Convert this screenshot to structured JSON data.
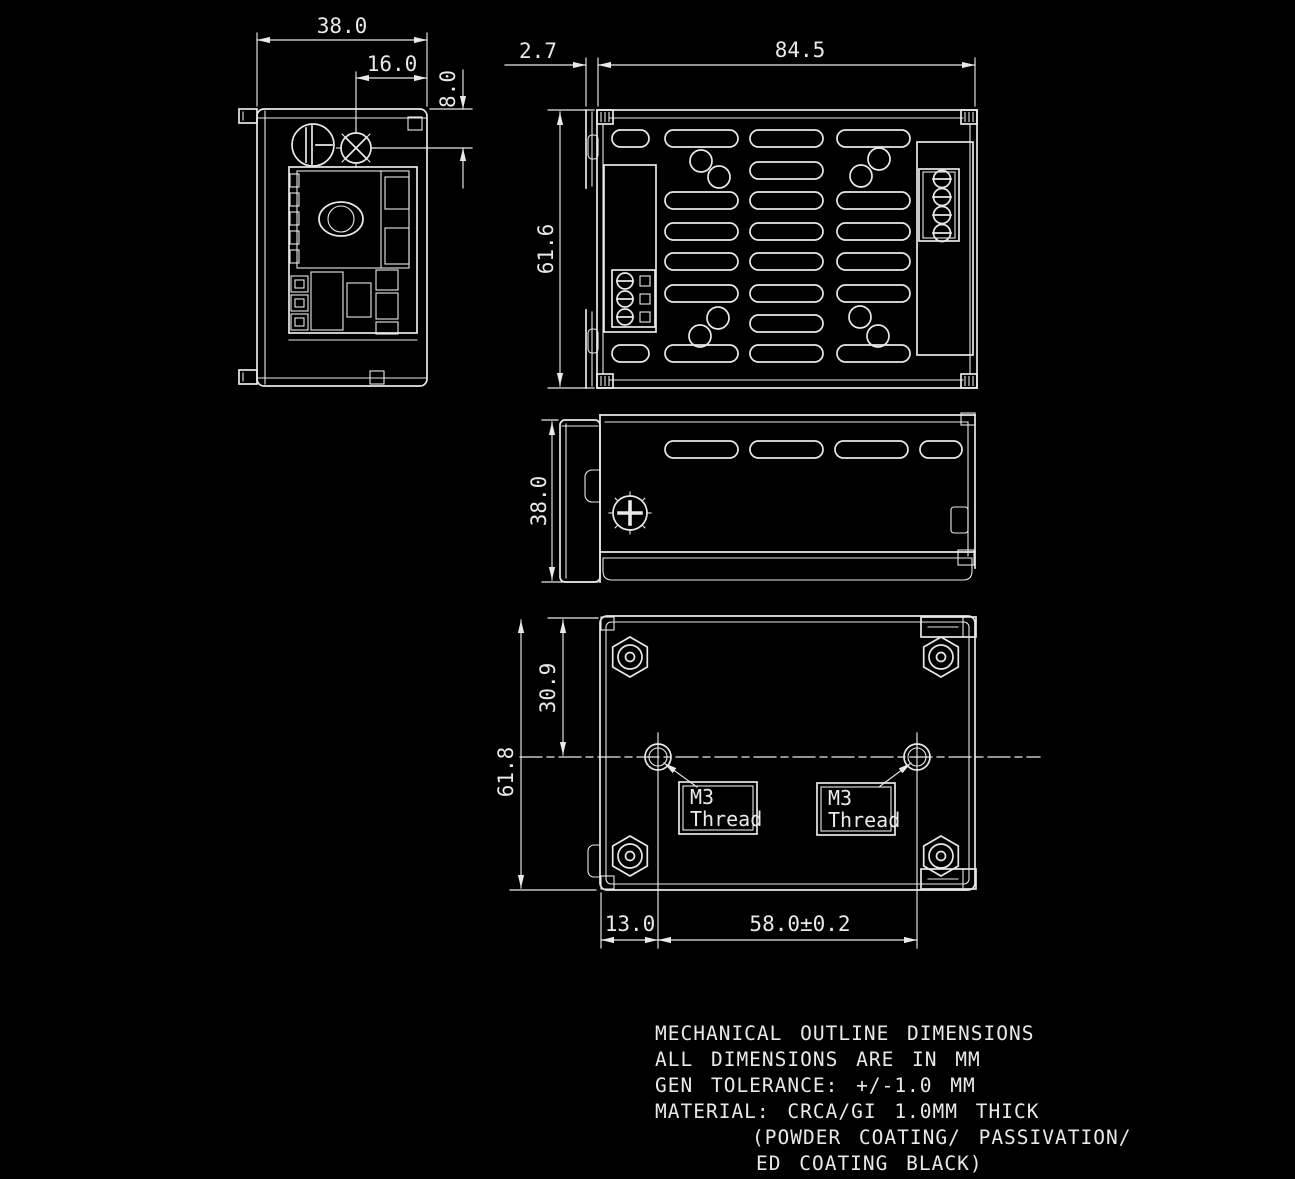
{
  "drawing": {
    "type": "mechanical-outline-drawing",
    "line_color": "#e9e9e9",
    "background_color": "#000000"
  },
  "views": {
    "end_view": {
      "dims": {
        "width": "38.0",
        "screw_offset": "16.0",
        "screw_height": "8.0"
      }
    },
    "top_view": {
      "dims": {
        "lip": "2.7",
        "width": "84.5",
        "depth": "61.6"
      }
    },
    "side_view": {
      "dims": {
        "height": "38.0"
      }
    },
    "bottom_view": {
      "dims": {
        "hole_row_offset": "30.9",
        "depth": "61.8",
        "hole_left_offset": "13.0",
        "hole_spacing": "58.0±0.2"
      },
      "thread_label": {
        "line1": "M3",
        "line2": "Thread"
      }
    }
  },
  "notes": {
    "line1": "MECHANICAL OUTLINE DIMENSIONS",
    "line2": "ALL DIMENSIONS ARE IN MM",
    "line3": "GEN TOLERANCE: +/-1.0 MM",
    "line4": "MATERIAL: CRCA/GI 1.0MM THICK",
    "line5": "(POWDER COATING/ PASSIVATION/",
    "line6": "ED COATING BLACK)"
  }
}
